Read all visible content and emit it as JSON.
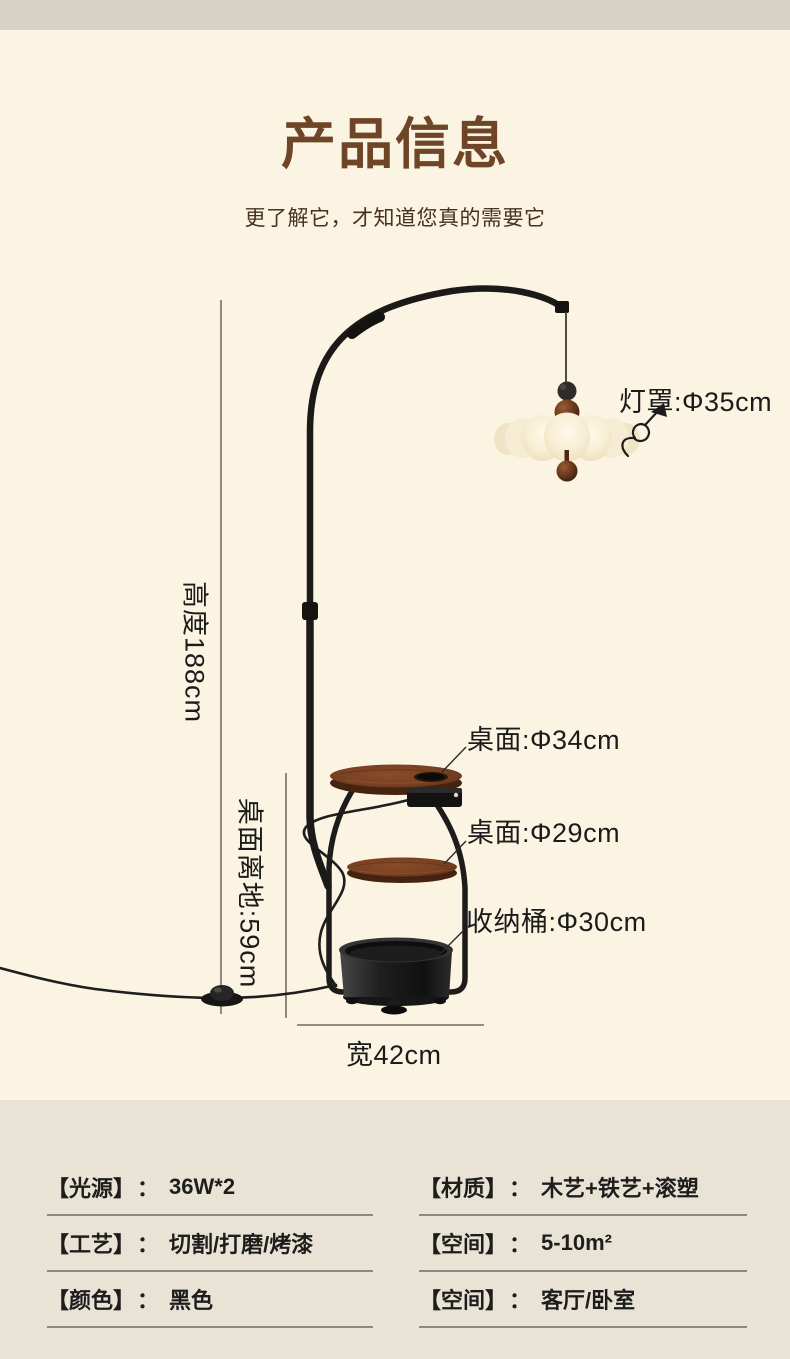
{
  "page": {
    "top_band_color": "#d8d2c5",
    "background_color": "#fbf4e2",
    "specs_background_color": "#e9e3d5",
    "title_color": "#6e4527"
  },
  "header": {
    "title": "产品信息",
    "subtitle": "更了解它，才知道您真的需要它"
  },
  "diagram": {
    "shade_label": "灯罩:Φ35cm",
    "height_label": "高度188cm",
    "table1_label": "桌面:Φ34cm",
    "table2_label": "桌面:Φ29cm",
    "table_height_label": "桌面离地:59cm",
    "bucket_label": "收纳桶:Φ30cm",
    "width_label": "宽42cm"
  },
  "specs": {
    "colon": "：",
    "left": [
      {
        "label": "【光源】",
        "value": "36W*2"
      },
      {
        "label": "【工艺】",
        "value": "切割/打磨/烤漆"
      },
      {
        "label": "【颜色】",
        "value": "黑色"
      }
    ],
    "right": [
      {
        "label": "【材质】",
        "value": "木艺+铁艺+滚塑"
      },
      {
        "label": "【空间】",
        "value": "5-10m²"
      },
      {
        "label": "【空间】",
        "value": "客厅/卧室"
      }
    ]
  }
}
